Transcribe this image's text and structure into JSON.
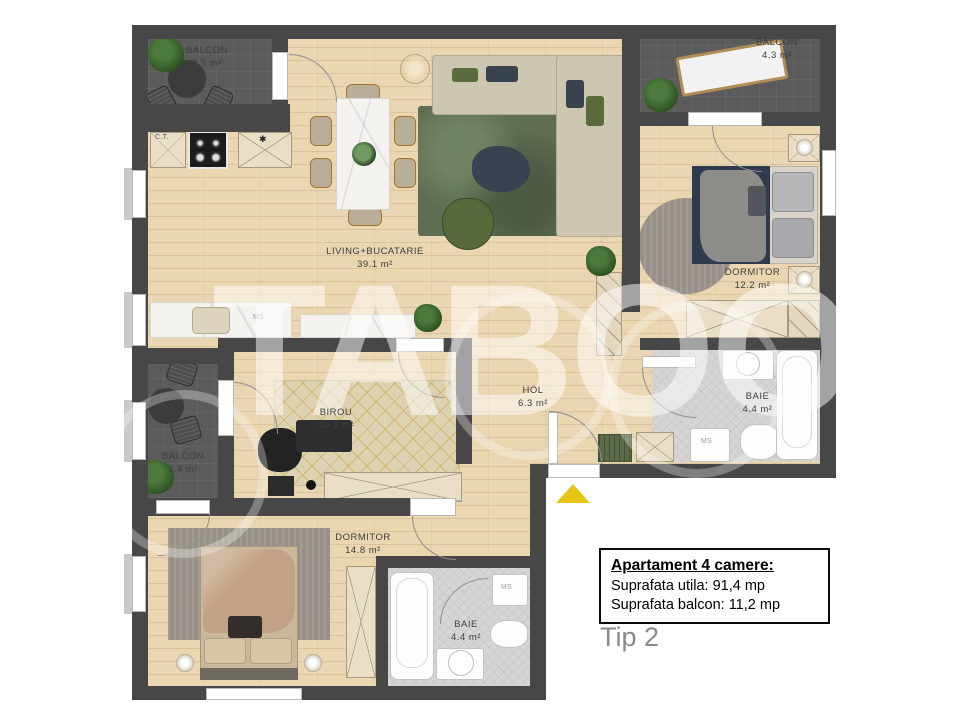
{
  "plan": {
    "watermark": "TABOO",
    "rooms": [
      {
        "id": "balcon-tl",
        "label": "BALCON",
        "area": "3.5 m²"
      },
      {
        "id": "balcon-tr",
        "label": "BALCON",
        "area": "4.3 m²"
      },
      {
        "id": "living",
        "label": "LIVING+BUCATARIE",
        "area": "39.1 m²"
      },
      {
        "id": "dormitor-tr",
        "label": "DORMITOR",
        "area": "12.2 m²"
      },
      {
        "id": "baie-tr",
        "label": "BAIE",
        "area": "4.4 m²"
      },
      {
        "id": "hol",
        "label": "HOL",
        "area": "6.3 m²"
      },
      {
        "id": "birou",
        "label": "BIROU",
        "area": "10.2 m²"
      },
      {
        "id": "balcon-left",
        "label": "BALCON",
        "area": "3.4 m²"
      },
      {
        "id": "dormitor-bottom",
        "label": "DORMITOR",
        "area": "14.8 m²"
      },
      {
        "id": "baie-bottom",
        "label": "BAIE",
        "area": "4.4 m²"
      }
    ],
    "annotations": {
      "ct": "C.T.",
      "star": "✱",
      "ms": "MS"
    },
    "colors": {
      "wall": "#474747",
      "wood": "#ead6b0",
      "balcony_floor": "#5b5b5b",
      "entrance_triangle": "#e8c417",
      "living_rug": "#5f6e52"
    }
  },
  "info_panel": {
    "title": "Apartament 4 camere:",
    "line_utila": "Suprafata utila: 91,4 mp",
    "line_balcon": "Suprafata balcon: 11,2 mp",
    "type_label": "Tip 2"
  }
}
